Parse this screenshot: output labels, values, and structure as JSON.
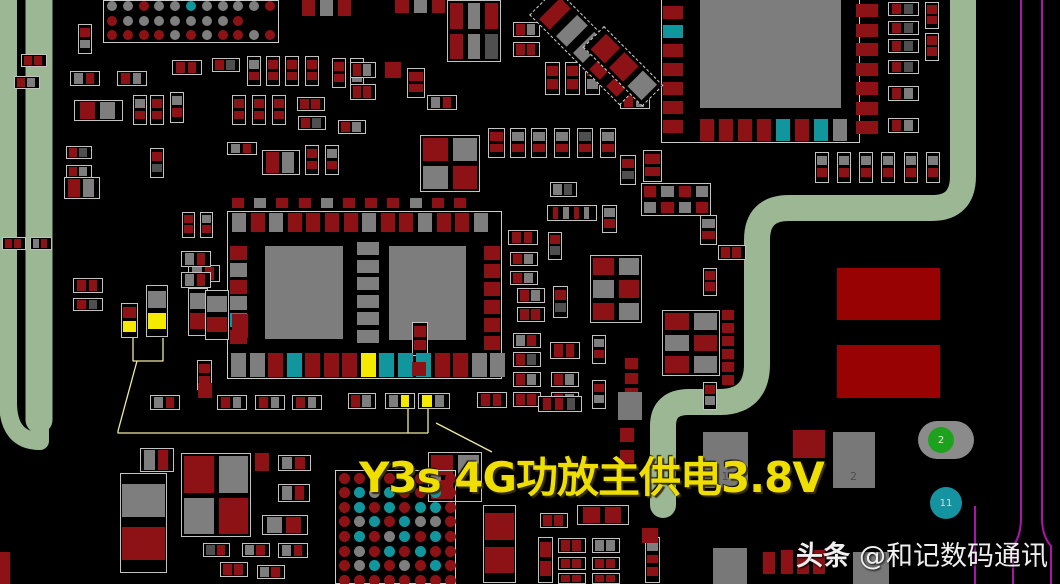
{
  "annotation": {
    "text": "Y3s 4G功放主供电3.8V",
    "color": "#eedf00"
  },
  "watermark": {
    "brand": "头条",
    "handle": "@和记数码通讯"
  },
  "palette": {
    "r": "#8d1216",
    "g": "#7e7e7e",
    "d": "#4f4f4f",
    "t": "#12969e",
    "y": "#f4ea00",
    "G": "#787878",
    "R": "#990202",
    "k": ""
  },
  "colors": {
    "background": "#000000",
    "trace_green": "#9cb793",
    "line_purple": "#ae13ae",
    "callout_yellow": "#efe9a0",
    "outline_white": "#c9c9c9",
    "annotation_yellow": "#eedf00",
    "watermark_white": "#efefef",
    "ic_gray": "#7d7d7d",
    "big_red": "#990202"
  },
  "markers": {
    "green": {
      "x": 918,
      "y": 421,
      "w": 56,
      "h": 38,
      "cx": 941,
      "cy": 440,
      "r": 13,
      "color": "#1ea21e",
      "label": "2"
    },
    "teal": {
      "cx": 946,
      "cy": 503,
      "r": 16,
      "color": "#1693a0",
      "label": "11"
    }
  },
  "pad_labels": [
    {
      "x": 703,
      "y": 432,
      "w": 45,
      "h": 56,
      "label": "1"
    },
    {
      "x": 833,
      "y": 432,
      "w": 42,
      "h": 56,
      "label": "2"
    }
  ],
  "traces": {
    "green": [
      {
        "d": "M8,-6 L8,402 Q8,441 40,441 L40,-6",
        "w": 18
      },
      {
        "d": "M39,-6 L39,420",
        "w": 27
      },
      {
        "d": "M963,-6 L963,176 Q963,208 932,208 L789,208 Q757,208 757,240 L757,364 Q757,401 721,402 L689,402 Q663,402 663,426 L663,505",
        "w": 26
      }
    ],
    "purple": [
      {
        "d": "M1021,-5 L1021,518 Q1021,536 1013,546 L1013,590",
        "w": 2
      },
      {
        "d": "M1042,-5 L1042,518 Q1042,536 1051,546 L1051,590",
        "w": 2
      },
      {
        "d": "M975,506 L975,590",
        "w": 2
      }
    ],
    "callouts": [
      {
        "d": "M133,338 L133,361 L163,361 L163,338",
        "w": 1.3
      },
      {
        "d": "M137,361 L118,431 L118,433 L428,433",
        "w": 1.3
      },
      {
        "d": "M408,433 L408,409",
        "w": 1.3
      },
      {
        "d": "M428,433 L428,409",
        "w": 1.3
      },
      {
        "d": "M436,423 L492,452",
        "w": 1.3
      }
    ]
  },
  "boxes": [
    [
      227,
      211,
      275,
      168
    ],
    [
      661,
      -2,
      199,
      145
    ]
  ],
  "solids": [
    [
      265,
      246,
      78,
      93,
      "#7d7d7d"
    ],
    [
      389,
      246,
      77,
      94,
      "#7d7d7d"
    ],
    [
      700,
      0,
      141,
      108,
      "#7d7d7d"
    ],
    [
      837,
      268,
      103,
      52,
      "#990202"
    ],
    [
      837,
      345,
      103,
      53,
      "#990202"
    ]
  ],
  "bgas": [
    {
      "x": 103,
      "y": 0,
      "w": 176,
      "h": 43,
      "x0": 9,
      "y0": 6,
      "px": 15.8,
      "py": 14.5,
      "r": 5,
      "rows": [
        "ggrggtggggr",
        "rgggggggr..",
        "rrrrgrgrrgr"
      ]
    },
    {
      "x": 335,
      "y": 470,
      "w": 121,
      "h": 114,
      "x0": 9,
      "y0": 8,
      "px": 15.2,
      "py": 14.6,
      "r": 5.5,
      "rows": [
        "rrrr.rgr",
        "rtgtrrtr",
        "rtrtrttr",
        "rgtrtggr",
        "rtrgtrtr",
        "rgrtrtrr",
        "rgtrgrtr",
        "rrrrrrrr"
      ]
    }
  ],
  "padrows": [
    [
      232,
      198,
      12,
      10,
      22.2,
      "rgrrgrrrgrr"
    ],
    [
      232,
      213,
      14,
      19,
      18.6,
      "grgrrrrgrrgrrg"
    ],
    [
      231,
      353,
      15,
      24,
      18.5,
      "ggrtrrrytttrrgg"
    ],
    [
      700,
      119,
      14,
      22,
      19,
      "rrrrtrtg"
    ]
  ],
  "padcols": [
    [
      357,
      242,
      22,
      13,
      17.6,
      "gggggg"
    ],
    [
      230,
      246,
      17,
      14,
      16.8,
      "rgrgtr"
    ],
    [
      484,
      246,
      16,
      14,
      18,
      "rrrrrr"
    ],
    [
      663,
      6,
      20,
      13,
      19,
      "rtrrrrr"
    ],
    [
      856,
      4,
      22,
      13,
      19.5,
      "rrrrrrr"
    ],
    [
      722,
      310,
      12,
      10,
      13,
      "rrrrrr"
    ],
    [
      625,
      358,
      13,
      11,
      15,
      "rrrr"
    ]
  ],
  "grids": [
    [
      447,
      0,
      54,
      62,
      3,
      "rgrrgd"
    ],
    [
      420,
      135,
      60,
      57,
      2,
      "rggr"
    ],
    [
      590,
      255,
      52,
      68,
      2,
      "rggrrg"
    ],
    [
      641,
      183,
      70,
      33,
      4,
      "rgrggrgr"
    ],
    [
      662,
      310,
      58,
      66,
      2,
      "rggrrg"
    ],
    [
      181,
      453,
      70,
      84,
      2,
      "rggr"
    ],
    [
      428,
      452,
      54,
      50,
      2,
      "rgrk"
    ]
  ],
  "diags": [
    [
      556,
      -12,
      128,
      38,
      "rggrr"
    ],
    [
      604,
      26,
      84,
      30,
      "rrg"
    ]
  ],
  "pads": [
    [
      302,
      0,
      13,
      16,
      "r"
    ],
    [
      320,
      0,
      13,
      16,
      "g"
    ],
    [
      338,
      0,
      13,
      16,
      "r"
    ],
    [
      395,
      0,
      14,
      13,
      "r"
    ],
    [
      414,
      0,
      13,
      13,
      "g"
    ],
    [
      432,
      0,
      13,
      13,
      "r"
    ],
    [
      385,
      62,
      16,
      16,
      "r"
    ],
    [
      198,
      383,
      14,
      15,
      "r"
    ],
    [
      255,
      453,
      14,
      18,
      "r"
    ],
    [
      232,
      314,
      16,
      24,
      "r"
    ],
    [
      620,
      407,
      14,
      12,
      "g"
    ],
    [
      620,
      428,
      14,
      14,
      "r"
    ],
    [
      620,
      450,
      14,
      14,
      "r"
    ],
    [
      642,
      528,
      16,
      15,
      "r"
    ],
    [
      793,
      430,
      32,
      28,
      "r"
    ],
    [
      763,
      552,
      12,
      22,
      "r"
    ],
    [
      781,
      550,
      12,
      24,
      "r"
    ],
    [
      797,
      554,
      12,
      20,
      "r"
    ],
    [
      813,
      550,
      12,
      24,
      "r"
    ],
    [
      713,
      548,
      34,
      36,
      "G"
    ],
    [
      853,
      552,
      36,
      32,
      "G"
    ],
    [
      618,
      392,
      24,
      28,
      "G"
    ],
    [
      0,
      552,
      10,
      32,
      "r"
    ],
    [
      412,
      362,
      14,
      14,
      "r"
    ]
  ],
  "comps": [
    [
      78,
      24,
      14,
      30,
      "v",
      "rg"
    ],
    [
      21,
      54,
      26,
      13,
      "h",
      "rr"
    ],
    [
      14,
      76,
      26,
      13,
      "h",
      "rg"
    ],
    [
      70,
      71,
      30,
      15,
      "h",
      "gr"
    ],
    [
      117,
      71,
      30,
      15,
      "h",
      "rg"
    ],
    [
      74,
      100,
      49,
      21,
      "h",
      "rg"
    ],
    [
      133,
      95,
      14,
      30,
      "v",
      "gr"
    ],
    [
      150,
      95,
      14,
      30,
      "v",
      "rr"
    ],
    [
      170,
      92,
      14,
      31,
      "v",
      "gr"
    ],
    [
      172,
      60,
      30,
      15,
      "h",
      "rr"
    ],
    [
      212,
      58,
      28,
      14,
      "h",
      "rd"
    ],
    [
      247,
      56,
      14,
      30,
      "v",
      "gr"
    ],
    [
      266,
      56,
      14,
      30,
      "v",
      "rr"
    ],
    [
      285,
      56,
      14,
      30,
      "v",
      "rr"
    ],
    [
      305,
      56,
      14,
      30,
      "v",
      "rr"
    ],
    [
      232,
      95,
      14,
      30,
      "v",
      "rr"
    ],
    [
      252,
      95,
      14,
      30,
      "v",
      "rr"
    ],
    [
      272,
      95,
      14,
      30,
      "v",
      "rr"
    ],
    [
      297,
      97,
      28,
      14,
      "h",
      "rr"
    ],
    [
      298,
      116,
      28,
      14,
      "h",
      "rd"
    ],
    [
      332,
      58,
      14,
      30,
      "v",
      "rr"
    ],
    [
      350,
      58,
      14,
      30,
      "v",
      "rg"
    ],
    [
      338,
      120,
      28,
      14,
      "h",
      "rg"
    ],
    [
      66,
      146,
      26,
      13,
      "h",
      "rd"
    ],
    [
      66,
      165,
      26,
      13,
      "h",
      "rg"
    ],
    [
      150,
      148,
      14,
      30,
      "v",
      "rd"
    ],
    [
      227,
      142,
      30,
      13,
      "h",
      "gr"
    ],
    [
      262,
      150,
      38,
      25,
      "h",
      "rg"
    ],
    [
      305,
      145,
      14,
      30,
      "v",
      "rr"
    ],
    [
      325,
      145,
      14,
      30,
      "v",
      "gr"
    ],
    [
      64,
      177,
      36,
      22,
      "h",
      "rg"
    ],
    [
      2,
      237,
      24,
      13,
      "h",
      "rr"
    ],
    [
      30,
      237,
      22,
      13,
      "h",
      "gr"
    ],
    [
      513,
      22,
      27,
      15,
      "h",
      "rg"
    ],
    [
      513,
      42,
      27,
      15,
      "h",
      "rr"
    ],
    [
      545,
      62,
      15,
      33,
      "v",
      "rr"
    ],
    [
      565,
      62,
      15,
      33,
      "v",
      "rr"
    ],
    [
      585,
      62,
      15,
      33,
      "v",
      "rg"
    ],
    [
      620,
      93,
      30,
      16,
      "h",
      "rg"
    ],
    [
      350,
      62,
      26,
      16,
      "h",
      "rg"
    ],
    [
      350,
      84,
      26,
      16,
      "h",
      "rr"
    ],
    [
      407,
      68,
      18,
      30,
      "v",
      "rr"
    ],
    [
      427,
      95,
      30,
      15,
      "h",
      "gr"
    ],
    [
      488,
      128,
      17,
      30,
      "v",
      "rr"
    ],
    [
      510,
      128,
      16,
      30,
      "v",
      "gr"
    ],
    [
      531,
      128,
      16,
      30,
      "v",
      "gr"
    ],
    [
      554,
      128,
      16,
      30,
      "v",
      "gr"
    ],
    [
      577,
      128,
      16,
      30,
      "v",
      "dr"
    ],
    [
      600,
      128,
      16,
      30,
      "v",
      "gr"
    ],
    [
      620,
      155,
      16,
      30,
      "v",
      "rd"
    ],
    [
      643,
      150,
      19,
      32,
      "v",
      "rr"
    ],
    [
      550,
      182,
      27,
      15,
      "h",
      "gd"
    ],
    [
      508,
      230,
      30,
      15,
      "h",
      "rr"
    ],
    [
      510,
      252,
      28,
      14,
      "h",
      "rg"
    ],
    [
      510,
      271,
      28,
      14,
      "h",
      "rg"
    ],
    [
      517,
      288,
      28,
      15,
      "h",
      "rg"
    ],
    [
      517,
      307,
      28,
      15,
      "h",
      "rr"
    ],
    [
      548,
      232,
      14,
      28,
      "v",
      "rd"
    ],
    [
      553,
      286,
      15,
      32,
      "v",
      "rd"
    ],
    [
      513,
      333,
      28,
      15,
      "h",
      "gr"
    ],
    [
      513,
      352,
      28,
      15,
      "h",
      "rd"
    ],
    [
      550,
      342,
      30,
      17,
      "h",
      "rr"
    ],
    [
      513,
      372,
      28,
      15,
      "h",
      "rg"
    ],
    [
      551,
      372,
      28,
      15,
      "h",
      "rg"
    ],
    [
      513,
      392,
      28,
      15,
      "h",
      "rr"
    ],
    [
      551,
      392,
      28,
      15,
      "h",
      "rg"
    ],
    [
      592,
      335,
      14,
      29,
      "v",
      "gr"
    ],
    [
      592,
      380,
      14,
      29,
      "v",
      "rg"
    ],
    [
      602,
      205,
      15,
      28,
      "v",
      "gr"
    ],
    [
      547,
      205,
      50,
      16,
      "h",
      "rgrg"
    ],
    [
      700,
      215,
      17,
      30,
      "v",
      "gr"
    ],
    [
      718,
      245,
      28,
      15,
      "h",
      "rr"
    ],
    [
      703,
      268,
      14,
      28,
      "v",
      "rr"
    ],
    [
      703,
      382,
      14,
      28,
      "v",
      "rg"
    ],
    [
      538,
      396,
      44,
      16,
      "h",
      "rrd"
    ],
    [
      73,
      278,
      30,
      15,
      "h",
      "rr"
    ],
    [
      73,
      298,
      30,
      13,
      "h",
      "rd"
    ],
    [
      121,
      303,
      17,
      35,
      "v",
      "ry"
    ],
    [
      146,
      285,
      22,
      52,
      "v",
      "gy"
    ],
    [
      188,
      288,
      20,
      48,
      "v",
      "gr"
    ],
    [
      188,
      265,
      32,
      17,
      "h",
      "gr"
    ],
    [
      197,
      360,
      15,
      30,
      "v",
      "rr"
    ],
    [
      150,
      395,
      30,
      15,
      "h",
      "gr"
    ],
    [
      217,
      395,
      30,
      15,
      "h",
      "rg"
    ],
    [
      255,
      395,
      30,
      15,
      "h",
      "rg"
    ],
    [
      292,
      395,
      30,
      15,
      "h",
      "rg"
    ],
    [
      348,
      393,
      28,
      16,
      "h",
      "rg"
    ],
    [
      385,
      393,
      30,
      16,
      "h",
      "gy"
    ],
    [
      418,
      393,
      32,
      16,
      "h",
      "yg"
    ],
    [
      477,
      392,
      30,
      16,
      "h",
      "rr"
    ],
    [
      182,
      212,
      13,
      26,
      "v",
      "rr"
    ],
    [
      200,
      212,
      13,
      26,
      "v",
      "gr"
    ],
    [
      181,
      251,
      30,
      16,
      "h",
      "gr"
    ],
    [
      181,
      272,
      30,
      16,
      "h",
      "gr"
    ],
    [
      205,
      290,
      24,
      50,
      "v",
      "gr"
    ],
    [
      412,
      322,
      16,
      34,
      "v",
      "rr"
    ],
    [
      140,
      448,
      34,
      24,
      "h",
      "gr"
    ],
    [
      120,
      473,
      47,
      100,
      "v",
      "gr"
    ],
    [
      278,
      455,
      33,
      16,
      "h",
      "gr"
    ],
    [
      278,
      484,
      32,
      18,
      "h",
      "gr"
    ],
    [
      262,
      515,
      46,
      20,
      "h",
      "gr"
    ],
    [
      203,
      543,
      27,
      14,
      "h",
      "dr"
    ],
    [
      242,
      543,
      28,
      14,
      "h",
      "gr"
    ],
    [
      278,
      543,
      30,
      15,
      "h",
      "gr"
    ],
    [
      220,
      562,
      28,
      15,
      "h",
      "rr"
    ],
    [
      257,
      565,
      28,
      14,
      "h",
      "gr"
    ],
    [
      483,
      505,
      33,
      78,
      "v",
      "rr"
    ],
    [
      540,
      513,
      28,
      15,
      "h",
      "rr"
    ],
    [
      577,
      505,
      52,
      20,
      "h",
      "rr"
    ],
    [
      558,
      538,
      28,
      15,
      "h",
      "rr"
    ],
    [
      592,
      538,
      28,
      15,
      "h",
      "gg"
    ],
    [
      558,
      557,
      28,
      13,
      "h",
      "rr"
    ],
    [
      592,
      557,
      28,
      13,
      "h",
      "rr"
    ],
    [
      558,
      573,
      28,
      11,
      "h",
      "rr"
    ],
    [
      592,
      573,
      28,
      11,
      "h",
      "rr"
    ],
    [
      538,
      537,
      15,
      46,
      "v",
      "rr"
    ],
    [
      645,
      537,
      15,
      46,
      "v",
      "grr"
    ],
    [
      888,
      2,
      31,
      14,
      "h",
      "rd"
    ],
    [
      888,
      21,
      31,
      14,
      "h",
      "rd"
    ],
    [
      888,
      39,
      31,
      14,
      "h",
      "rd"
    ],
    [
      888,
      60,
      31,
      14,
      "h",
      "rd"
    ],
    [
      888,
      86,
      31,
      15,
      "h",
      "rg"
    ],
    [
      888,
      118,
      31,
      15,
      "h",
      "rg"
    ],
    [
      925,
      2,
      14,
      27,
      "v",
      "rr"
    ],
    [
      925,
      33,
      14,
      28,
      "v",
      "rr"
    ],
    [
      815,
      152,
      14,
      31,
      "v",
      "gr"
    ],
    [
      837,
      152,
      14,
      31,
      "v",
      "gr"
    ],
    [
      859,
      152,
      14,
      31,
      "v",
      "gr"
    ],
    [
      881,
      152,
      14,
      31,
      "v",
      "gr"
    ],
    [
      904,
      152,
      14,
      31,
      "v",
      "gr"
    ],
    [
      926,
      152,
      14,
      31,
      "v",
      "gr"
    ]
  ]
}
